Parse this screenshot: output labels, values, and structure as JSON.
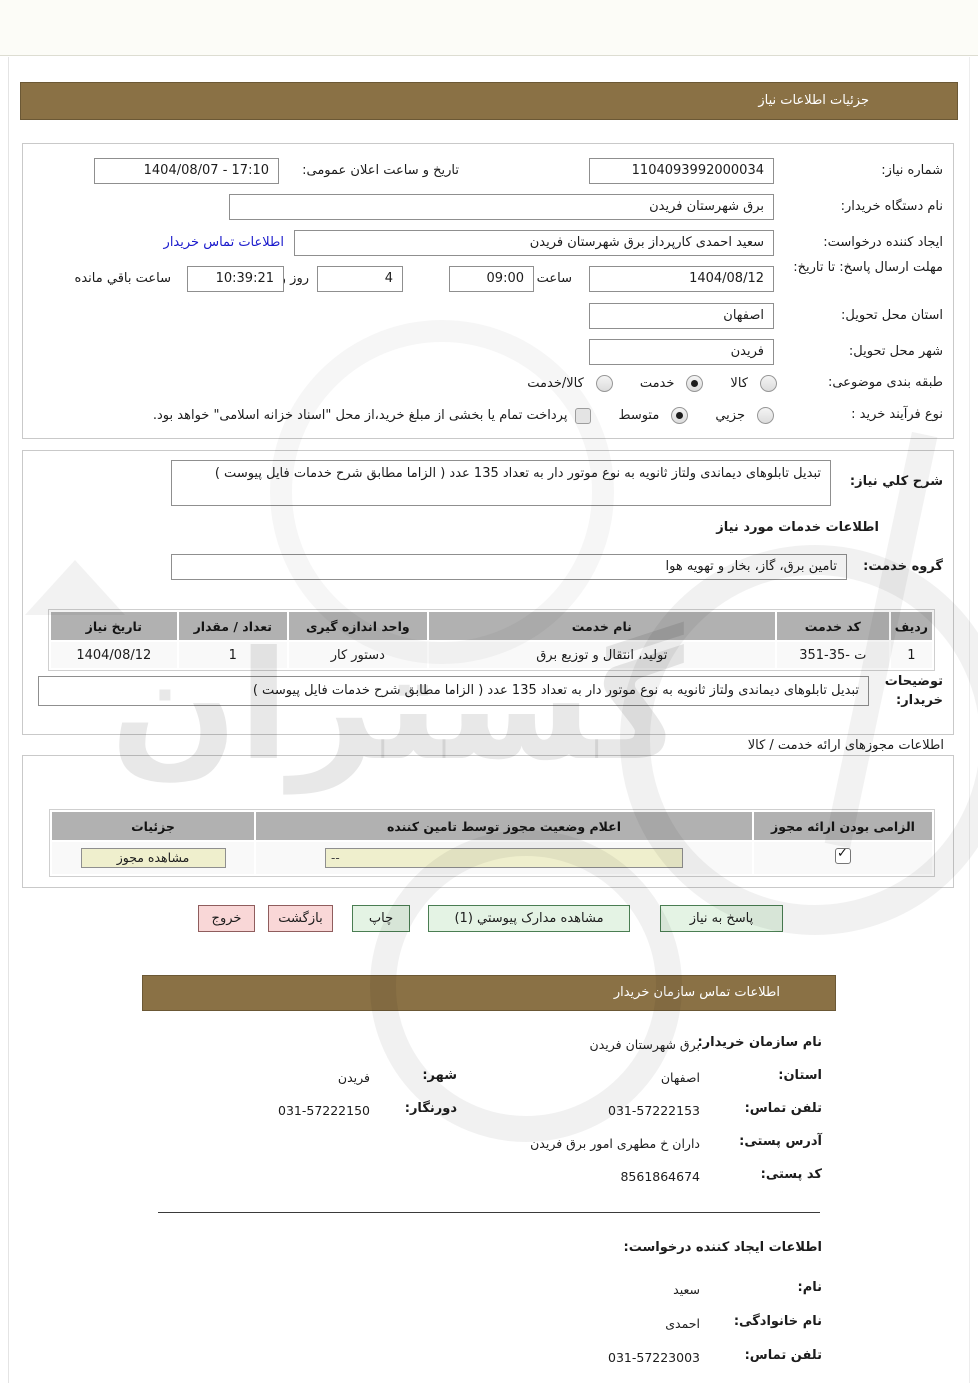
{
  "page": {
    "title": "جزئیات اطلاعات نیاز"
  },
  "watermark": {
    "text": "گستران"
  },
  "form": {
    "need_number": {
      "label": "شماره نیاز:",
      "value": "1104093992000034"
    },
    "announce": {
      "label": "تاریخ و ساعت اعلان عمومی:",
      "value": "1404/08/07 - 17:10"
    },
    "buyer_org": {
      "label": "نام دستگاه خریدار:",
      "value": "برق شهرستان فریدن"
    },
    "creator": {
      "label": "ایجاد کننده درخواست:",
      "value": "سعید احمدی کارپرداز برق شهرستان فریدن",
      "contact_link": "اطلاعات تماس خریدار"
    },
    "deadline": {
      "label": "مهلت ارسال پاسخ: تا تاریخ:",
      "date": "1404/08/12",
      "hour_label": "ساعت",
      "time": "09:00",
      "days": "4",
      "days_label": "روز و",
      "remaining": "10:39:21",
      "remaining_label": "ساعت باقي مانده"
    },
    "province": {
      "label": "استان محل تحویل:",
      "value": "اصفهان"
    },
    "city": {
      "label": "شهر محل تحویل:",
      "value": "فریدن"
    },
    "category": {
      "label": "طبقه بندی موضوعی:",
      "option_goods": "کالا",
      "option_service": "خدمت",
      "option_goods_service": "کالا/خدمت",
      "selected": "خدمت"
    },
    "process": {
      "label": "نوع فرآیند خرید :",
      "option_minor": "جزيي",
      "option_medium": "متوسط",
      "selected": "متوسط",
      "treasury_note": "پرداخت تمام یا بخشی از مبلغ خرید،از محل \"اسناد خزانه اسلامی\" خواهد بود."
    }
  },
  "services": {
    "desc_label": "شرح کلي نیاز:",
    "desc_value": "تبدیل تابلوهای دیماندی ولتاز ثانویه به نوع موتور دار به تعداد 135 عدد ( الزاما مطابق شرح خدمات فایل پیوست )",
    "heading": "اطلاعات خدمات مورد نیاز",
    "group_label": "گروه خدمت:",
    "group_value": "تامین برق، گاز، بخار و تهویه هوا",
    "table": {
      "headers": [
        "ردیف",
        "کد خدمت",
        "نام خدمت",
        "واحد اندازه گیری",
        "تعداد / مقدار",
        "تاریخ نیاز"
      ],
      "row": {
        "index": "1",
        "code": "351-35- ت",
        "name": "تولید، انتقال و توزیع برق",
        "unit": "دستور کار",
        "qty": "1",
        "date": "1404/08/12"
      }
    },
    "notes_label": "توضیحات خریدار:",
    "notes_value": "تبدیل تابلوهای دیماندی ولتاز ثانویه به نوع موتور دار به تعداد 135 عدد ( الزاما مطابق شرح خدمات فایل پیوست )"
  },
  "licenses": {
    "heading": "اطلاعات مجوزهای ارائه خدمت / کالا",
    "headers": [
      "الزامی بودن ارائه مجوز",
      "اعلام وضعیت مجوز توسط تامین کننده",
      "جزئیات"
    ],
    "required_checked": true,
    "status_value": "--",
    "view_button": "مشاهده مجوز"
  },
  "buttons": {
    "respond": "پاسخ به نیاز",
    "attachments": "مشاهده مدارک پیوستي (1)",
    "print": "چاپ",
    "back": "بازگشت",
    "exit": "خروج"
  },
  "contact": {
    "bar_title": "اطلاعات تماس سازمان خریدار",
    "org_label": "نام سازمان خریدار:",
    "org_value": "برق شهرستان فریدن",
    "province_label": "استان:",
    "province_value": "اصفهان",
    "city_label": "شهر:",
    "city_value": "فریدن",
    "phone_label": "تلفن تماس:",
    "phone_value": "031-57222153",
    "fax_label": "دورنگار:",
    "fax_value": "031-57222150",
    "address_label": "آدرس پستی:",
    "address_value": "داران خ مطهری امور برق فریدن",
    "postal_label": "کد پستی:",
    "postal_value": "8561864674"
  },
  "creator_info": {
    "heading": "اطلاعات ایجاد کننده درخواست:",
    "name_label": "نام:",
    "name_value": "سعید",
    "lastname_label": "نام خانوادگی:",
    "lastname_value": "احمدی",
    "phone_label": "تلفن تماس:",
    "phone_value": "031-57223003"
  }
}
